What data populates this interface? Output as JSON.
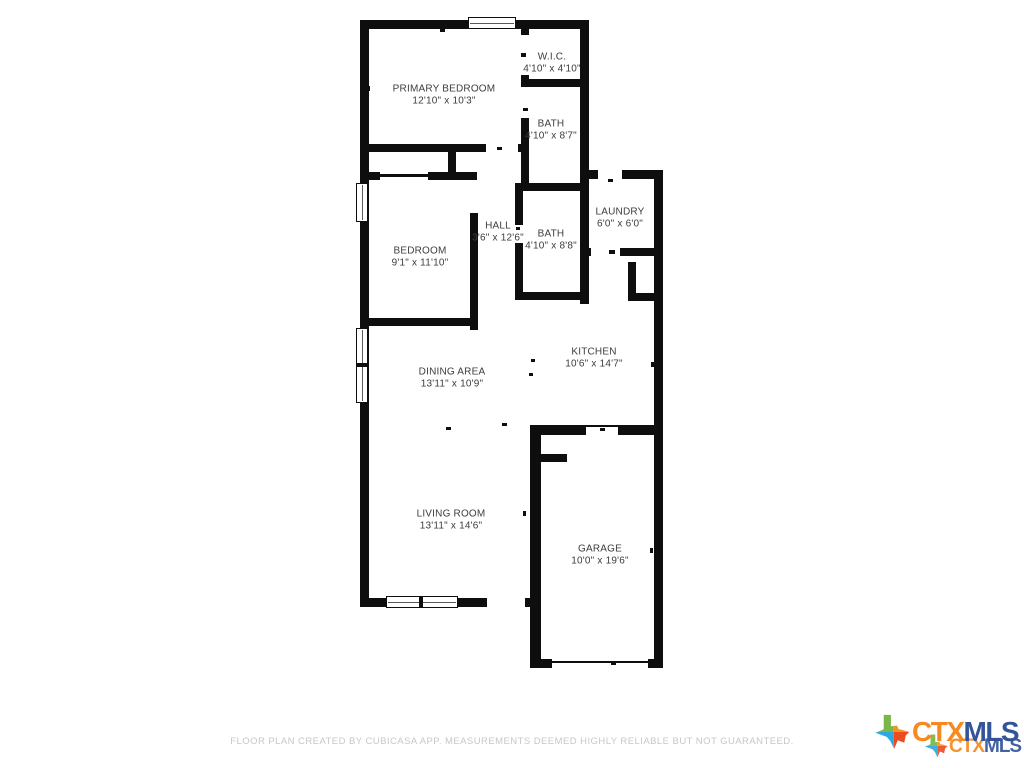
{
  "floor_plan": {
    "rooms": [
      {
        "name": "PRIMARY BEDROOM",
        "dims": "12'10\" x 10'3\""
      },
      {
        "name": "W.I.C.",
        "dims": "4'10\" x 4'10\""
      },
      {
        "name": "BATH",
        "dims": "4'10\" x 8'7\""
      },
      {
        "name": "BEDROOM",
        "dims": "9'1\" x 11'10\""
      },
      {
        "name": "HALL",
        "dims": "3'6\" x 12'6\""
      },
      {
        "name": "BATH",
        "dims": "4'10\" x 8'8\""
      },
      {
        "name": "LAUNDRY",
        "dims": "6'0\" x 6'0\""
      },
      {
        "name": "KITCHEN",
        "dims": "10'6\" x 14'7\""
      },
      {
        "name": "DINING AREA",
        "dims": "13'11\" x 10'9\""
      },
      {
        "name": "LIVING ROOM",
        "dims": "13'11\" x 14'6\""
      },
      {
        "name": "GARAGE",
        "dims": "10'0\" x 19'6\""
      }
    ]
  },
  "footer": {
    "disclaimer": "FLOOR PLAN CREATED BY CUBICASA APP. MEASUREMENTS DEEMED HIGHLY RELIABLE BUT NOT GUARANTEED."
  },
  "branding": {
    "logo_part_1": "CTX",
    "logo_part_2": "MLS",
    "colors": {
      "ctx_orange": "#F6891F",
      "mls_blue": "#33549B",
      "texas_green": "#7AB648",
      "texas_orange": "#F09622",
      "texas_teal": "#2BAAE1",
      "texas_red": "#EE4B23"
    }
  }
}
